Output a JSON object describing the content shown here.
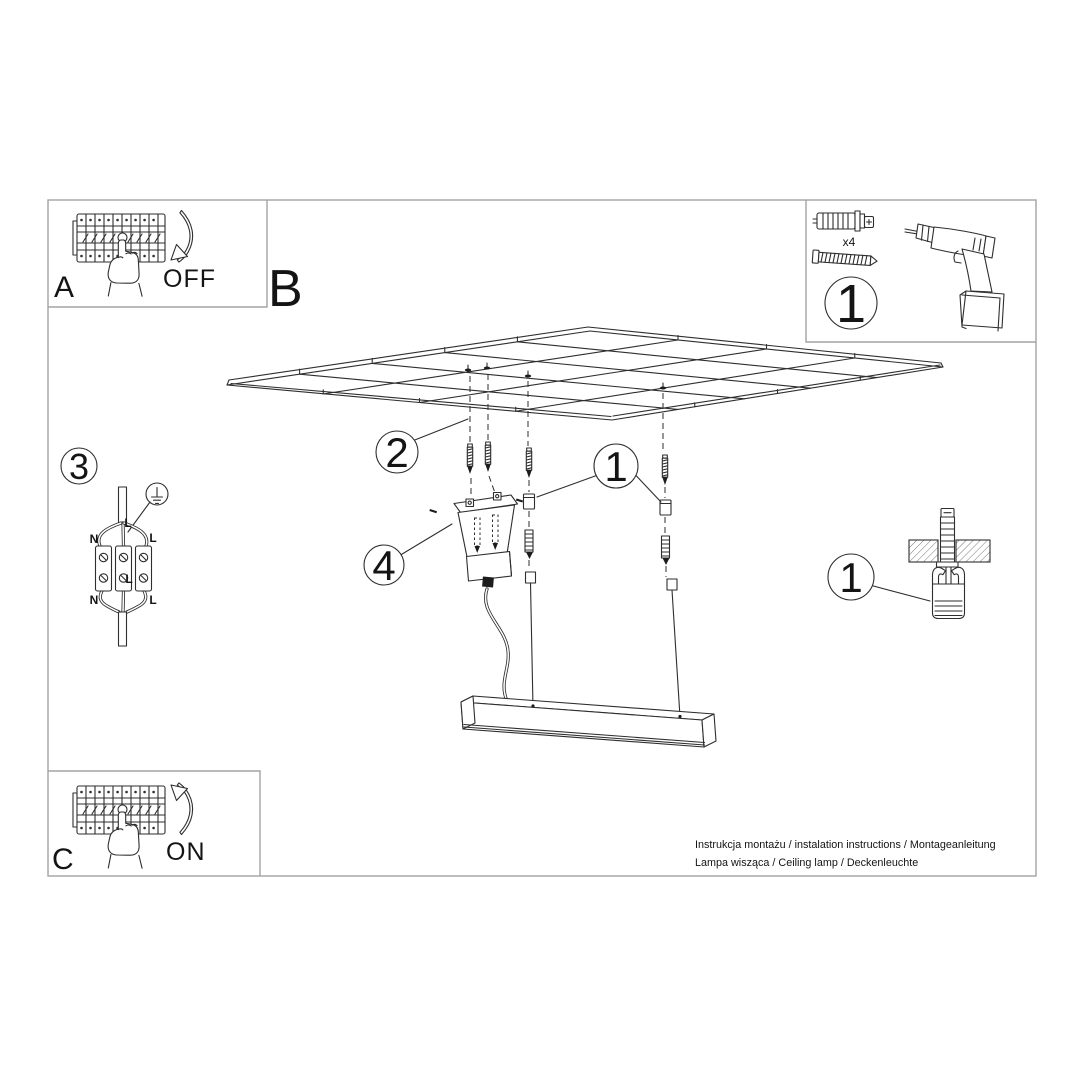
{
  "colors": {
    "line": "#2e2e2e",
    "frame": "#a3a3a3",
    "text": "#141414"
  },
  "steps": {
    "a": {
      "label": "A",
      "action": "OFF"
    },
    "b": {
      "label": "B"
    },
    "c": {
      "label": "C",
      "action": "ON"
    }
  },
  "tools_box": {
    "callout": "1",
    "anchor_qty": "x4"
  },
  "wiring": {
    "callout": "3",
    "labels": {
      "entry": "L",
      "top_left": "N",
      "top_right": "L",
      "center": "L",
      "bottom_left": "N",
      "bottom_right": "L"
    }
  },
  "callouts": {
    "screws": "2",
    "canopy": "4",
    "suspension": "1",
    "anchor_detail": "1"
  },
  "footer": {
    "line1": "Instrukcja montażu / instalation instructions / Montageanleitung",
    "line2": "Lampa wisząca / Ceiling lamp / Deckenleuchte"
  }
}
